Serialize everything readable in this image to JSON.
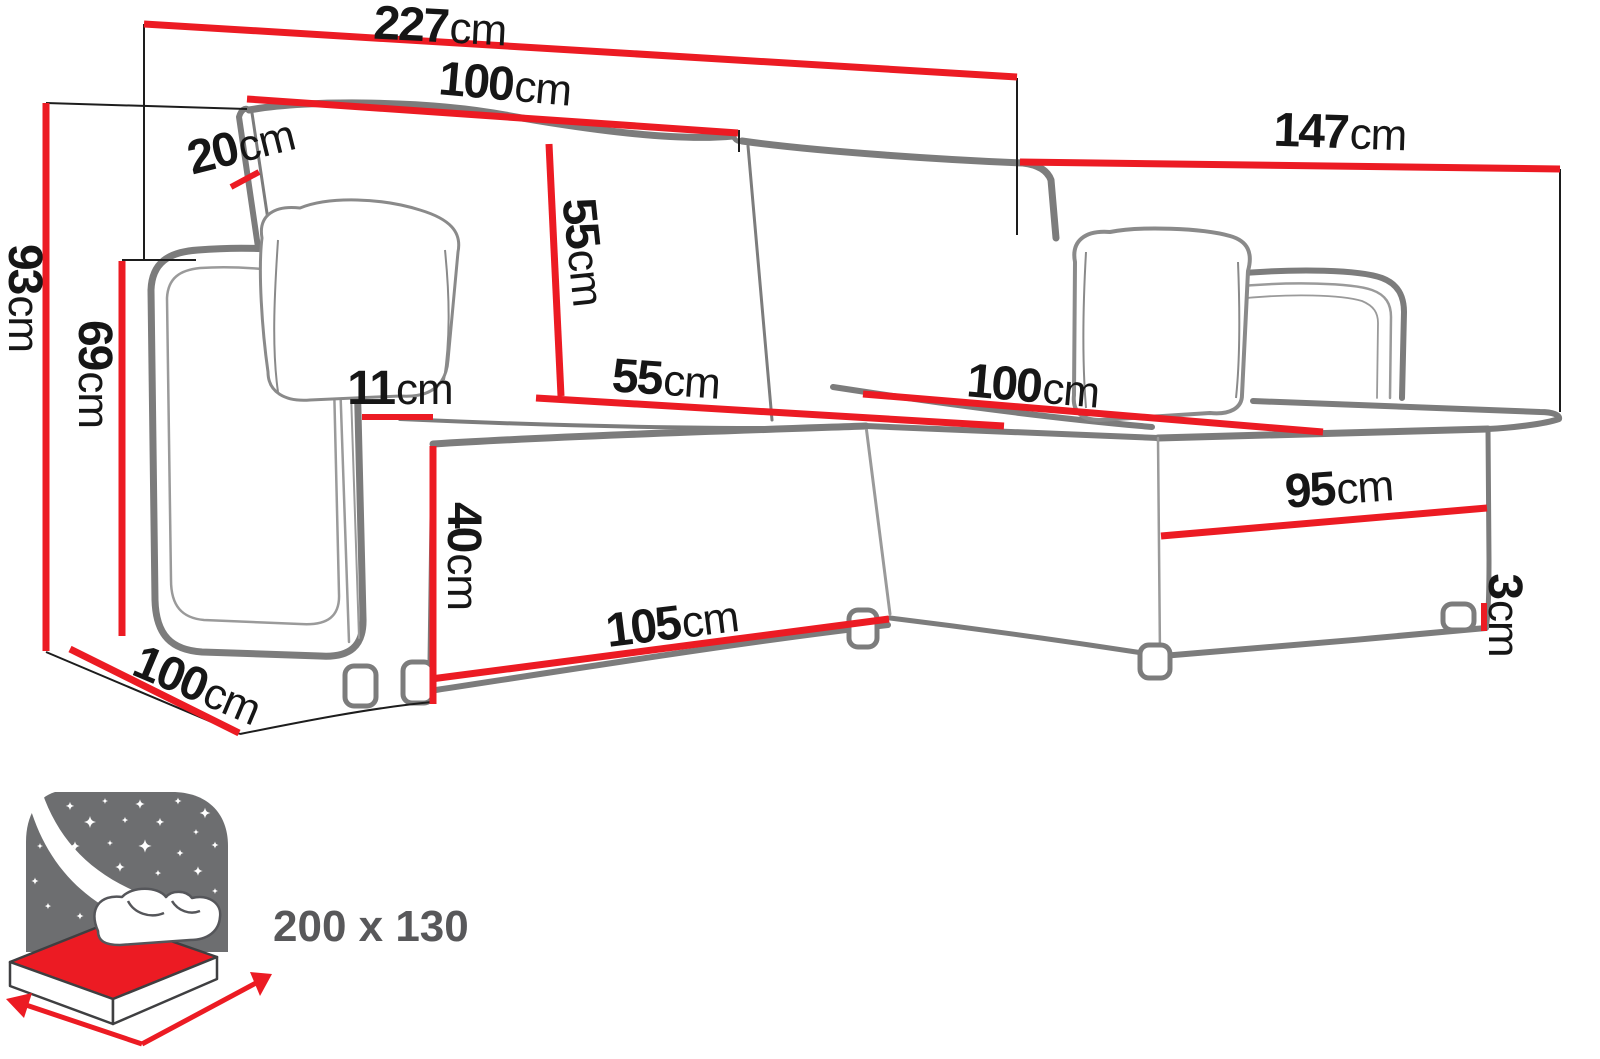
{
  "diagram": {
    "kind": "corner-sofa-dimension-drawing",
    "unit": "cm",
    "colors": {
      "dimension_line_red": "#ec1b23",
      "sofa_outline_gray": "#7c7c7c",
      "reference_line_black": "#1d1d1d",
      "label_text_black": "#161616",
      "icon_gray": "#6d6e70",
      "icon_text_gray": "#58585a"
    },
    "dimensions": {
      "total_width": {
        "value": "227",
        "unit": "cm"
      },
      "backrest_width": {
        "value": "100",
        "unit": "cm"
      },
      "backrest_depth": {
        "value": "20",
        "unit": "cm"
      },
      "chaise_length": {
        "value": "147",
        "unit": "cm"
      },
      "total_height": {
        "value": "93",
        "unit": "cm"
      },
      "armrest_height": {
        "value": "69",
        "unit": "cm"
      },
      "backrest_cushion_height": {
        "value": "55",
        "unit": "cm"
      },
      "seat_depth": {
        "value": "55",
        "unit": "cm"
      },
      "armrest_width": {
        "value": "11",
        "unit": "cm"
      },
      "seat_height": {
        "value": "40",
        "unit": "cm"
      },
      "seat_front_width": {
        "value": "105",
        "unit": "cm"
      },
      "chaise_top_width": {
        "value": "100",
        "unit": "cm"
      },
      "chaise_front_length": {
        "value": "95",
        "unit": "cm"
      },
      "leg_height": {
        "value": "3",
        "unit": "cm"
      },
      "side_depth": {
        "value": "100",
        "unit": "cm"
      }
    },
    "sleeping_area": {
      "label": "200 x 130"
    }
  }
}
